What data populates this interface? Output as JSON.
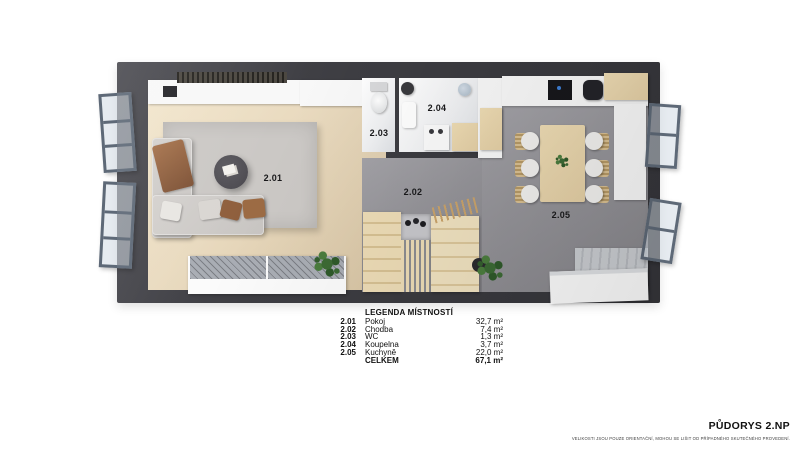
{
  "colors": {
    "wall": "#3e3e43",
    "wood_floor": "#e9dabf",
    "tile_floor": "#96959a",
    "rug": "#cbc8c5",
    "stair_wood": "#eddcb6",
    "counter_wood": "#e4cfa5",
    "sofa": "#c8c5c2",
    "bath_tile": "#f0f1f3",
    "window_frame": "#5e6977",
    "plant": "#3c6a34",
    "text": "#111111"
  },
  "legend": {
    "title": "LEGENDA MÍSTNOSTÍ",
    "rows": [
      {
        "num": "2.01",
        "name": "Pokoj",
        "area": "32,7 m²"
      },
      {
        "num": "2.02",
        "name": "Chodba",
        "area": "7,4 m²"
      },
      {
        "num": "2.03",
        "name": "WC",
        "area": "1,3 m²"
      },
      {
        "num": "2.04",
        "name": "Koupelna",
        "area": "3,7 m²"
      },
      {
        "num": "2.05",
        "name": "Kuchyně",
        "area": "22,0 m²"
      }
    ],
    "total_label": "CELKEM",
    "total_area": "67,1 m²"
  },
  "footer": {
    "title": "PŮDORYS 2.NP",
    "disclaimer": "VELIKOSTI JSOU POUZE ORIENTAČNÍ, MOHOU SE LIŠIT OD PŘÍPADNÉHO SKUTEČNÉHO PROVEDENÍ."
  }
}
